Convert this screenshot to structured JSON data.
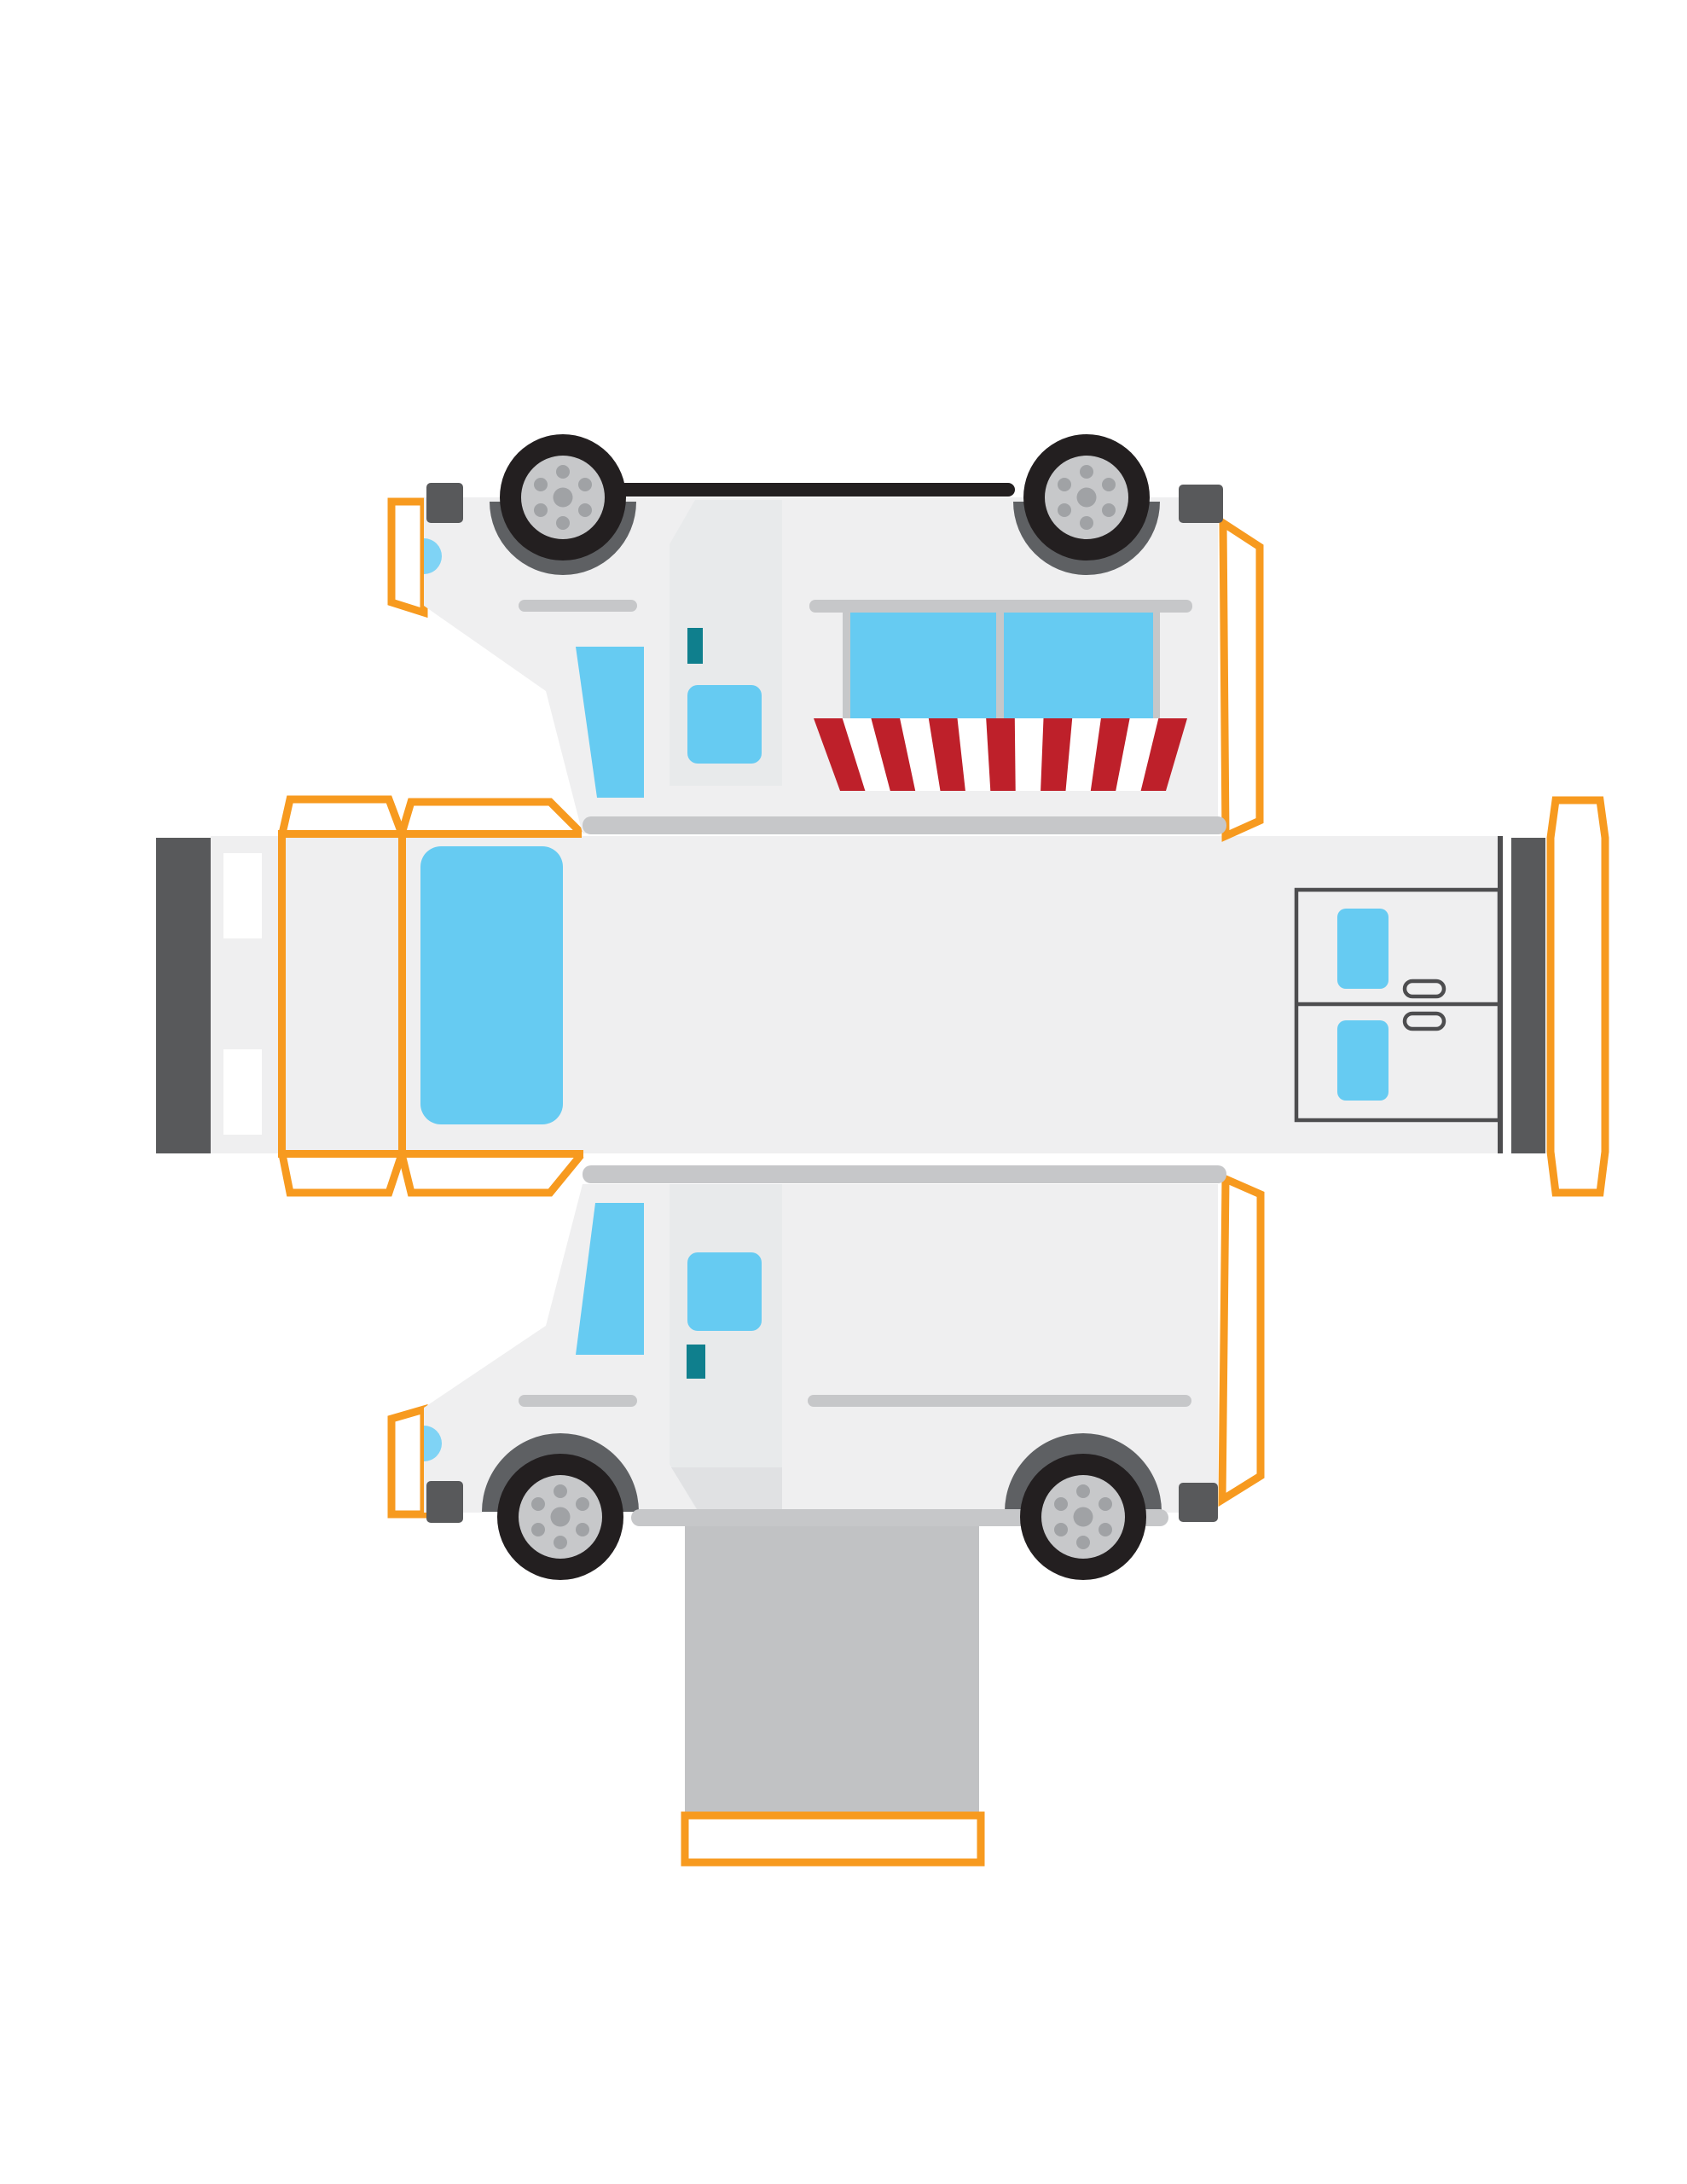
{
  "title": "ice-cream-truck-papercraft-template",
  "colors": {
    "background": "#FFFFFF",
    "body": "#EFEFF0",
    "door_panel": "#E8EAEB",
    "shadow": "#E0E1E3",
    "bar_gray": "#C6C7C9",
    "floor_gray": "#C1C2C4",
    "dark_gray": "#58595B",
    "wheel_well": "#5E6063",
    "tire": "#231F20",
    "hub": "#C7C8CA",
    "lug": "#A0A2A5",
    "window_blue": "#66CBF2",
    "headlight_blue": "#7FD3F5",
    "teal": "#0F7F8D",
    "awning_red": "#BE202A",
    "awning_white": "#FFFFFF",
    "tab_orange": "#F79A1F",
    "outline_gray": "#4D4D4F",
    "chassis_black": "#231F20"
  },
  "pieces": {
    "top_panel": "truck right side, printed upside-down, with serving window and awning",
    "middle_strip": "truck roof strip with front face, windshield fold and rear doors",
    "bottom_panel": "truck left side, upright",
    "floor_flap": "gray truck floor with glue tab"
  },
  "wheel": {
    "count": 4,
    "lug_count": 6
  },
  "awning": {
    "stripe_count": 13,
    "red_stripes": 7,
    "white_stripes": 6
  },
  "rear_doors": {
    "count": 2,
    "windows": 2,
    "handles": 2
  },
  "glue_tabs": {
    "count": 10
  },
  "headlights": {
    "count": 2
  },
  "serving_window_panes": 2
}
